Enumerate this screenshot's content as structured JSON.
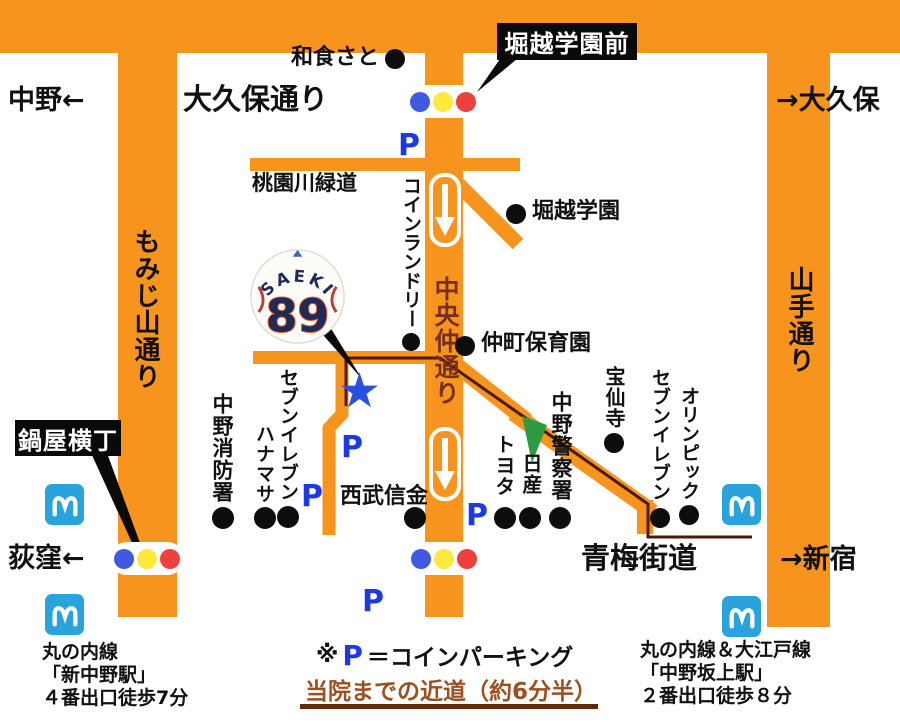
{
  "colors": {
    "road": "#F7941E",
    "parking_blue": "#1C39E8",
    "star_blue": "#2950E0",
    "metro_blue": "#29A3DC",
    "path_brown": "#4A1A05",
    "shortcut_text": "#9C501F",
    "green_arrow": "#2E9B44",
    "signal_blue": "#4059E0",
    "signal_yellow": "#FFE93C",
    "signal_red": "#EF4040",
    "chuo_naka_text": "#76301A"
  },
  "signs": {
    "okubo_dori": "大久保通り",
    "nakano_west": "中野←",
    "okubo_east": "→大久保",
    "ome_kaido": "青梅街道",
    "ogikubo_west": "荻窪←",
    "shinjuku_east": "→新宿",
    "momijiyama_dori": "もみじ山通り",
    "yamate_dori": "山手通り",
    "chuo_naka_dori": "中央仲通り",
    "momozonogawa_ryokudo": "桃園川緑道"
  },
  "callouts": {
    "horikoshi_gakuen_mae": "堀越学園前",
    "nabeya_yokocho": "鍋屋横丁"
  },
  "pois": {
    "washoku_sato": "和食さと",
    "horikoshi_gakuen": "堀越学園",
    "coin_laundry": "コインランドリー",
    "nakamachi_hoikuen": "仲町保育園",
    "hosenji": "宝仙寺",
    "seven_eleven_east": "セブンイレブン",
    "olympic": "オリンピック",
    "nakano_police": "中野警察署",
    "nissan": "日産",
    "toyota": "トヨタ",
    "nakano_fire": "中野消防署",
    "seven_eleven_west": "セブンイレブン",
    "hanamasa": "ハナマサ",
    "seibu_shinkin": "西武信金"
  },
  "cap": {
    "name": "SAEKI",
    "number": "89"
  },
  "parking_mark": "P",
  "legend": {
    "note_prefix": "※",
    "p_symbol": "P",
    "note_suffix": "＝コインパーキング",
    "shortcut_note": "当院までの近道（約6分半）"
  },
  "stations": {
    "shin_nakano": {
      "line": "丸の内線",
      "name": "「新中野駅」",
      "walk": "４番出口徒歩7分"
    },
    "nakano_sakaue": {
      "line": "丸の内線＆大江戸線",
      "name": "「中野坂上駅」",
      "walk": "２番出口徒歩８分"
    }
  }
}
